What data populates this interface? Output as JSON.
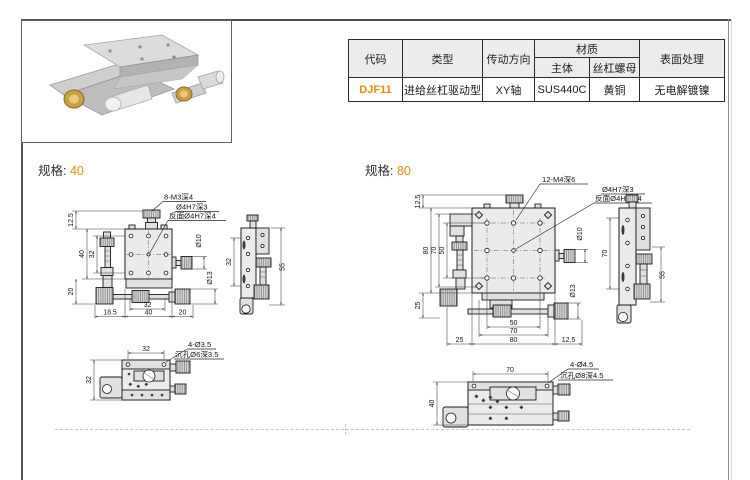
{
  "page": {
    "accent_color": "#f08a00"
  },
  "spec_table": {
    "header": {
      "code": "代码",
      "type": "类型",
      "direction": "传动方向",
      "material": "材质",
      "material_body": "主体",
      "material_nut": "丝杠螺母",
      "surface": "表面处理"
    },
    "row": {
      "code": "DJF11",
      "type": "进给丝杠驱动型",
      "direction": "XY轴",
      "material_body": "SUS440C",
      "material_nut": "黄铜",
      "surface": "无电解镀镍"
    }
  },
  "spec40": {
    "label": "规格:",
    "value": "40",
    "callout_top": "8-M3深4",
    "callout_center_1": "Ø4H7深3",
    "callout_center_2": "反面Ø4H7深4",
    "callout_base_1": "4-Ø3.5",
    "callout_base_2": "沉孔Ø6深3.5",
    "dim_knob_offset": "12.5",
    "dim_height_overall": "40",
    "dim_height_inner": "32",
    "dim_base_height": "20",
    "dim_bottom_inner": "32",
    "dim_bottom_left": "18.5",
    "dim_bottom_mid": "40",
    "dim_bottom_right": "20",
    "dim_dia_small": "Ø10",
    "dim_dia_large": "Ø13",
    "side_dim_inner": "32",
    "side_dim_height": "55",
    "base_dim_width": "32",
    "base_dim_height": "32"
  },
  "spec80": {
    "label": "规格:",
    "value": "80",
    "callout_top": "12-M4深6",
    "callout_center_1": "Ø4H7深3",
    "callout_center_2": "反面Ø4H7深4",
    "callout_base_1": "4-Ø4.5",
    "callout_base_2": "沉孔Ø8深4.5",
    "dim_knob_offset": "12.5",
    "dim_height_overall": "80",
    "dim_height_inner": "70",
    "dim_hole_span": "50",
    "dim_base_height": "25",
    "dim_bottom_hole_span": "50",
    "dim_bottom_inner": "70",
    "dim_bottom_left": "25",
    "dim_bottom_mid": "80",
    "dim_bottom_right": "12.5",
    "dim_dia_small": "Ø10",
    "dim_dia_large": "Ø13",
    "side_dim_inner": "70",
    "side_dim_height": "55",
    "base_dim_width": "70",
    "base_dim_height": "40"
  }
}
